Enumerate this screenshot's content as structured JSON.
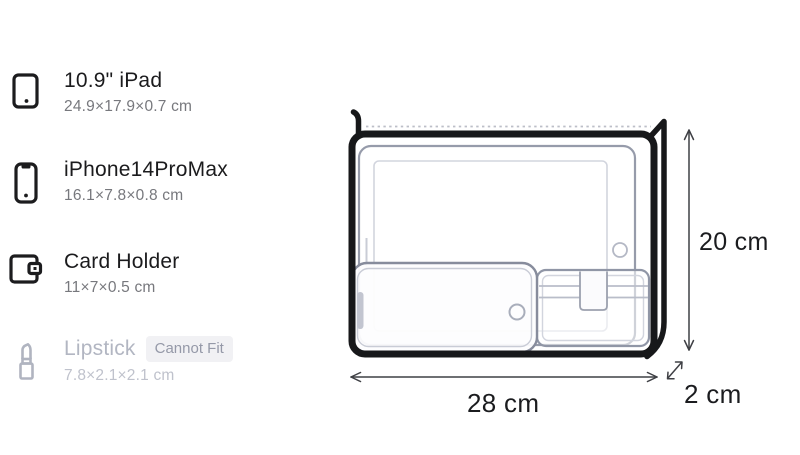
{
  "items": [
    {
      "name": "10.9\" iPad",
      "dimensions": "24.9×17.9×0.7 cm",
      "icon": "ipad-icon",
      "fits": true
    },
    {
      "name": "iPhone14ProMax",
      "dimensions": "16.1×7.8×0.8 cm",
      "icon": "iphone-icon",
      "fits": true
    },
    {
      "name": "Card Holder",
      "dimensions": "11×7×0.5 cm",
      "icon": "wallet-icon",
      "fits": true
    },
    {
      "name": "Lipstick",
      "dimensions": "7.8×2.1×2.1 cm",
      "icon": "lipstick-icon",
      "fits": false,
      "badge": "Cannot Fit"
    }
  ],
  "diagram": {
    "type": "bag-fit-visualization",
    "bag": {
      "width_label": "28 cm",
      "height_label": "20 cm",
      "depth_label": "2 cm"
    },
    "contents_shown": [
      "10.9\" iPad",
      "iPhone14ProMax",
      "Card Holder"
    ],
    "zipper": "dotted line along top edge"
  },
  "colors": {
    "title_text": "#1b1b1d",
    "subtitle_text": "#77787d",
    "disabled_text": "#b2b6c2",
    "badge_bg": "#f1f1f4",
    "badge_text": "#9599a8",
    "bag_outline": "#17181a",
    "item_outline": "#9096a6",
    "item_detail_line": "#d2d5de",
    "arrow": "#3f4045"
  }
}
